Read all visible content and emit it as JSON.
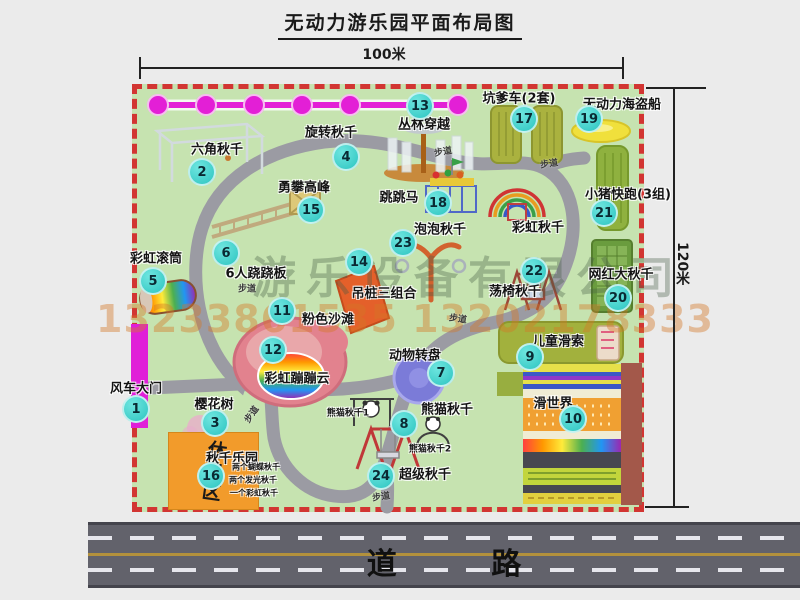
{
  "title": "无动力游乐园平面布局图",
  "dimensions": {
    "width": "100米",
    "height": "120米"
  },
  "road": {
    "label": "道 路"
  },
  "rest_area": {
    "label": "休息区"
  },
  "watermark": {
    "company": "游乐设备有限公司",
    "phone": "13233861535 13202178333"
  },
  "colors": {
    "park_green": "#c6e3b0",
    "border_red": "#d23532",
    "badge_cyan": "#2cc4c0",
    "zipline_magenta": "#e31fd6",
    "road_gray": "#62626b",
    "rest_orange": "#f29b2b"
  },
  "attractions": [
    {
      "num": "1",
      "name": "风车大门",
      "bx": 136,
      "by": 409,
      "lx": 136,
      "ly": 387
    },
    {
      "num": "2",
      "name": "六角秋千",
      "bx": 202,
      "by": 172,
      "lx": 217,
      "ly": 148
    },
    {
      "num": "3",
      "name": "樱花树",
      "bx": 215,
      "by": 423,
      "lx": 214,
      "ly": 403
    },
    {
      "num": "4",
      "name": "旋转秋千",
      "bx": 346,
      "by": 157,
      "lx": 331,
      "ly": 131
    },
    {
      "num": "5",
      "name": "彩虹滚筒",
      "bx": 153,
      "by": 281,
      "lx": 156,
      "ly": 257
    },
    {
      "num": "6",
      "name": "6人跷跷板",
      "bx": 226,
      "by": 253,
      "lx": 256,
      "ly": 272
    },
    {
      "num": "7",
      "name": "动物转盘",
      "bx": 441,
      "by": 373,
      "lx": 415,
      "ly": 354
    },
    {
      "num": "8",
      "name": "熊猫秋千",
      "bx": 404,
      "by": 424,
      "lx": 447,
      "ly": 408
    },
    {
      "num": "9",
      "name": "儿童滑索",
      "bx": 530,
      "by": 357,
      "lx": 558,
      "ly": 340
    },
    {
      "num": "10",
      "name": "滑世界",
      "bx": 573,
      "by": 419,
      "lx": 553,
      "ly": 402
    },
    {
      "num": "11",
      "name": "粉色沙滩",
      "bx": 282,
      "by": 311,
      "lx": 328,
      "ly": 318
    },
    {
      "num": "12",
      "name": "彩虹蹦蹦云",
      "bx": 273,
      "by": 350,
      "lx": 297,
      "ly": 377
    },
    {
      "num": "13",
      "name": "丛林穿越",
      "bx": 420,
      "by": 106,
      "lx": 424,
      "ly": 123
    },
    {
      "num": "14",
      "name": "吊桩三组合",
      "bx": 359,
      "by": 262,
      "lx": 384,
      "ly": 292
    },
    {
      "num": "15",
      "name": "勇攀高峰",
      "bx": 311,
      "by": 210,
      "lx": 304,
      "ly": 186
    },
    {
      "num": "16",
      "name": "秋千乐园",
      "bx": 211,
      "by": 476,
      "lx": 232,
      "ly": 457
    },
    {
      "num": "17",
      "name": "坑爹车(2套)",
      "bx": 524,
      "by": 119,
      "lx": 519,
      "ly": 97
    },
    {
      "num": "18",
      "name": "跳跳马",
      "bx": 438,
      "by": 203,
      "lx": 399,
      "ly": 196
    },
    {
      "num": "19",
      "name": "无动力海盗船",
      "bx": 589,
      "by": 119,
      "lx": 622,
      "ly": 103
    },
    {
      "num": "20",
      "name": "网红大秋千",
      "bx": 618,
      "by": 298,
      "lx": 621,
      "ly": 273
    },
    {
      "num": "21",
      "name": "小猪快跑(3组)",
      "bx": 604,
      "by": 213,
      "lx": 628,
      "ly": 193
    },
    {
      "num": "22",
      "name": "荡椅秋千",
      "bx": 534,
      "by": 271,
      "lx": 515,
      "ly": 290
    },
    {
      "num": "23",
      "name": "泡泡秋千",
      "bx": 403,
      "by": 243,
      "lx": 440,
      "ly": 228
    },
    {
      "num": "24",
      "name": "超级秋千",
      "bx": 381,
      "by": 476,
      "lx": 425,
      "ly": 473
    }
  ],
  "extra_labels": [
    {
      "text": "彩虹秋千",
      "x": 538,
      "y": 226,
      "size": 13
    },
    {
      "text": "熊猫秋千1",
      "x": 348,
      "y": 412,
      "size": 9
    },
    {
      "text": "熊猫秋千2",
      "x": 430,
      "y": 448,
      "size": 9
    },
    {
      "text": "两个蝴蝶秋千",
      "x": 256,
      "y": 467,
      "size": 8
    },
    {
      "text": "两个发光秋千",
      "x": 253,
      "y": 480,
      "size": 8
    },
    {
      "text": "一个彩虹秋千",
      "x": 254,
      "y": 493,
      "size": 8
    }
  ],
  "path_labels": [
    {
      "text": "步道",
      "x": 443,
      "y": 151,
      "rot": -10
    },
    {
      "text": "步道",
      "x": 549,
      "y": 163,
      "rot": -8
    },
    {
      "text": "步道",
      "x": 247,
      "y": 288,
      "rot": 0
    },
    {
      "text": "步道",
      "x": 458,
      "y": 318,
      "rot": 8
    },
    {
      "text": "步道",
      "x": 251,
      "y": 414,
      "rot": -55
    },
    {
      "text": "步道",
      "x": 381,
      "y": 496,
      "rot": -8
    }
  ]
}
